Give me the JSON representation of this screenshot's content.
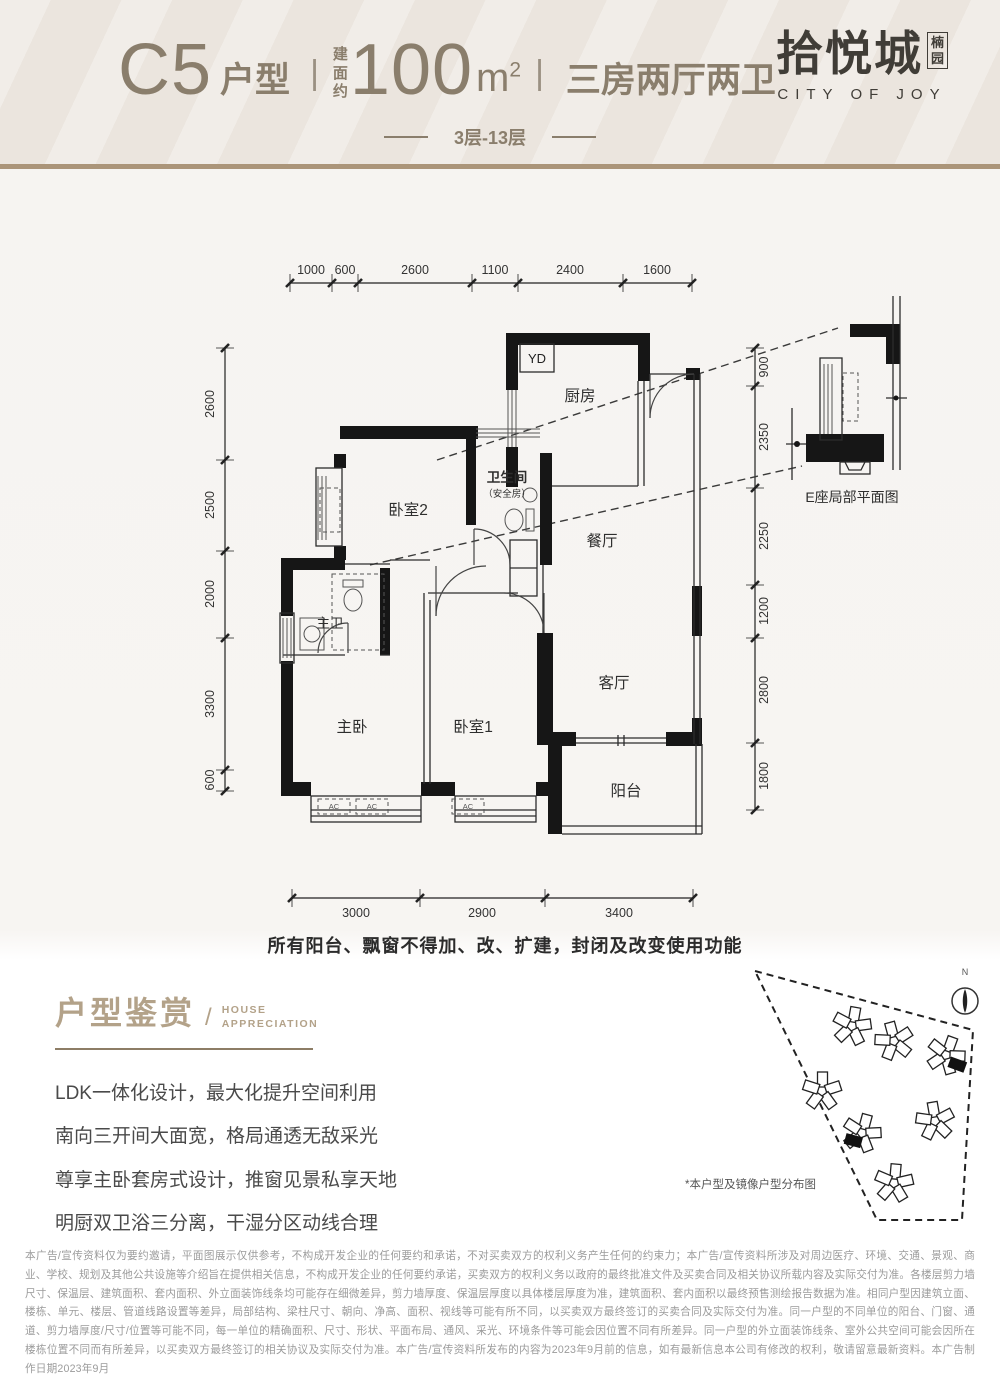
{
  "header": {
    "unit": "C5",
    "unit_suffix": "户型",
    "divider": "|",
    "area_prefix": "建面约",
    "area_value": "100",
    "area_unit": "m",
    "area_sup": "2",
    "layout": "三房两厅两卫",
    "floors": "3层-13层",
    "logo_cn": "拾悦城",
    "logo_badge": "楠园",
    "logo_en": "CITY OF JOY"
  },
  "plan": {
    "dims": {
      "top": [
        "1000",
        "600",
        "2600",
        "1100",
        "2400",
        "1600"
      ],
      "left": [
        "2600",
        "2500",
        "2000",
        "3300",
        "600"
      ],
      "right": [
        "900",
        "2350",
        "2250",
        "1200",
        "2800",
        "1800"
      ],
      "bottom": [
        "3000",
        "2900",
        "3400"
      ]
    },
    "rooms": {
      "yd": "YD",
      "kitchen": "厨房",
      "bath": "卫生间",
      "bath_sub": "（安全房）",
      "bed2": "卧室2",
      "dining": "餐厅",
      "master_bath": "主卫",
      "master_bed": "主卧",
      "bed1": "卧室1",
      "living": "客厅",
      "balcony": "阳台",
      "ac": "AC"
    },
    "detail_caption": "E座局部平面图",
    "note": "所有阳台、飘窗不得加、改、扩建，封闭及改变使用功能"
  },
  "appreciation": {
    "title_cn": "户型鉴赏",
    "slash": "/",
    "title_en1": "HOUSE",
    "title_en2": "APPRECIATION",
    "lines": [
      "LDK一体化设计，最大化提升空间利用",
      "南向三开间大面宽，格局通透无敌采光",
      "尊享主卧套房式设计，推窗见景私享天地",
      "明厨双卫浴三分离，干湿分区动线合理"
    ]
  },
  "siteplan": {
    "north": "N",
    "caption": "*本户型及镜像户型分布图"
  },
  "disclaimer": "本广告/宣传资料仅为要约邀请，平面图展示仅供参考，不构成开发企业的任何要约和承诺，不对买卖双方的权利义务产生任何的约束力；本广告/宣传资料所涉及对周边医疗、环境、交通、景观、商业、学校、规划及其他公共设施等介绍旨在提供相关信息，不构成开发企业的任何要约承诺，买卖双方的权利义务以政府的最终批准文件及买卖合同及相关协议所载内容及实际交付为准。各楼层剪力墙尺寸、保温层、建筑面积、套内面积、外立面装饰线条均可能存在细微差异，剪力墙厚度、保温层厚度以具体楼层厚度为准，建筑面积、套内面积以最终预售测绘报告数据为准。相同户型因建筑立面、楼栋、单元、楼层、管道线路设置等差异，局部结构、梁柱尺寸、朝向、净高、面积、视线等可能有所不同，以买卖双方最终签订的买卖合同及实际交付为准。同一户型的不同单位的阳台、门窗、通道、剪力墙厚度/尺寸/位置等可能不同，每一单位的精确面积、尺寸、形状、平面布局、通风、采光、环境条件等可能会因位置不同有所差异。同一户型的外立面装饰线条、室外公共空间可能会因所在楼栋位置不同而有所差异，以买卖双方最终签订的相关协议及实际交付为准。本广告/宣传资料所发布的内容为2023年9月前的信息，如有最新信息本公司有修改的权利，敬请留意最新资料。本广告制作日期2023年9月",
  "colors": {
    "band_bg": "#ebe5de",
    "band_border": "#ab9579",
    "header_text": "#8a7e6c",
    "logo": "#403d37",
    "accent": "#b3a289",
    "wall": "#161616"
  }
}
